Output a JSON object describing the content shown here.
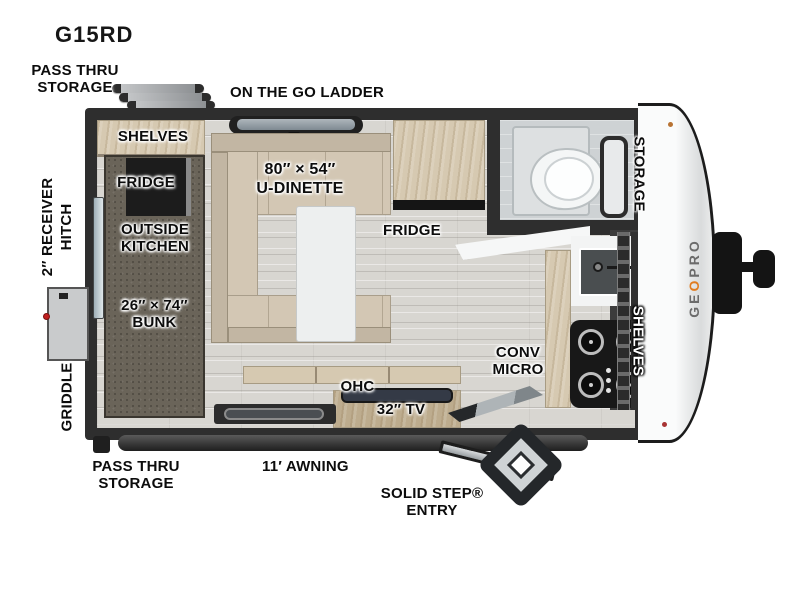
{
  "title": "G15RD",
  "colors": {
    "wall": "#2e2e2e",
    "floor": "#d8d6d1",
    "wood": "#d6c9b1",
    "carpet": "#6a6459",
    "cap_white": "#f5f6f6",
    "brand_orange": "#e07b1f",
    "griddle_red": "#c02020"
  },
  "exterior_labels": {
    "pass_thru_top": [
      "PASS THRU",
      "STORAGE"
    ],
    "ladder": "ON THE GO LADDER",
    "receiver_hitch": [
      "2″ RECEIVER",
      "HITCH"
    ],
    "griddle": "GRIDDLE",
    "pass_thru_bottom": [
      "PASS THRU",
      "STORAGE"
    ],
    "awning": "11′ AWNING",
    "entry": [
      "SOLID STEP®",
      "ENTRY"
    ],
    "brand": {
      "prefix": "GE",
      "o": "O",
      "suffix": "PRO"
    }
  },
  "room_labels": {
    "front_shelves": "SHELVES",
    "outside_fridge": "FRIDGE",
    "outside_kitchen": [
      "OUTSIDE",
      "KITCHEN"
    ],
    "bunk": [
      "26″ × 74″",
      "BUNK"
    ],
    "dinette": [
      "80″ × 54″",
      "U-DINETTE"
    ],
    "fridge": "FRIDGE",
    "bath_storage": "STORAGE",
    "conv_micro": [
      "CONV",
      "MICRO"
    ],
    "kitchen_shelves": "SHELVES",
    "ohc": "OHC",
    "tv": "32″ TV"
  }
}
